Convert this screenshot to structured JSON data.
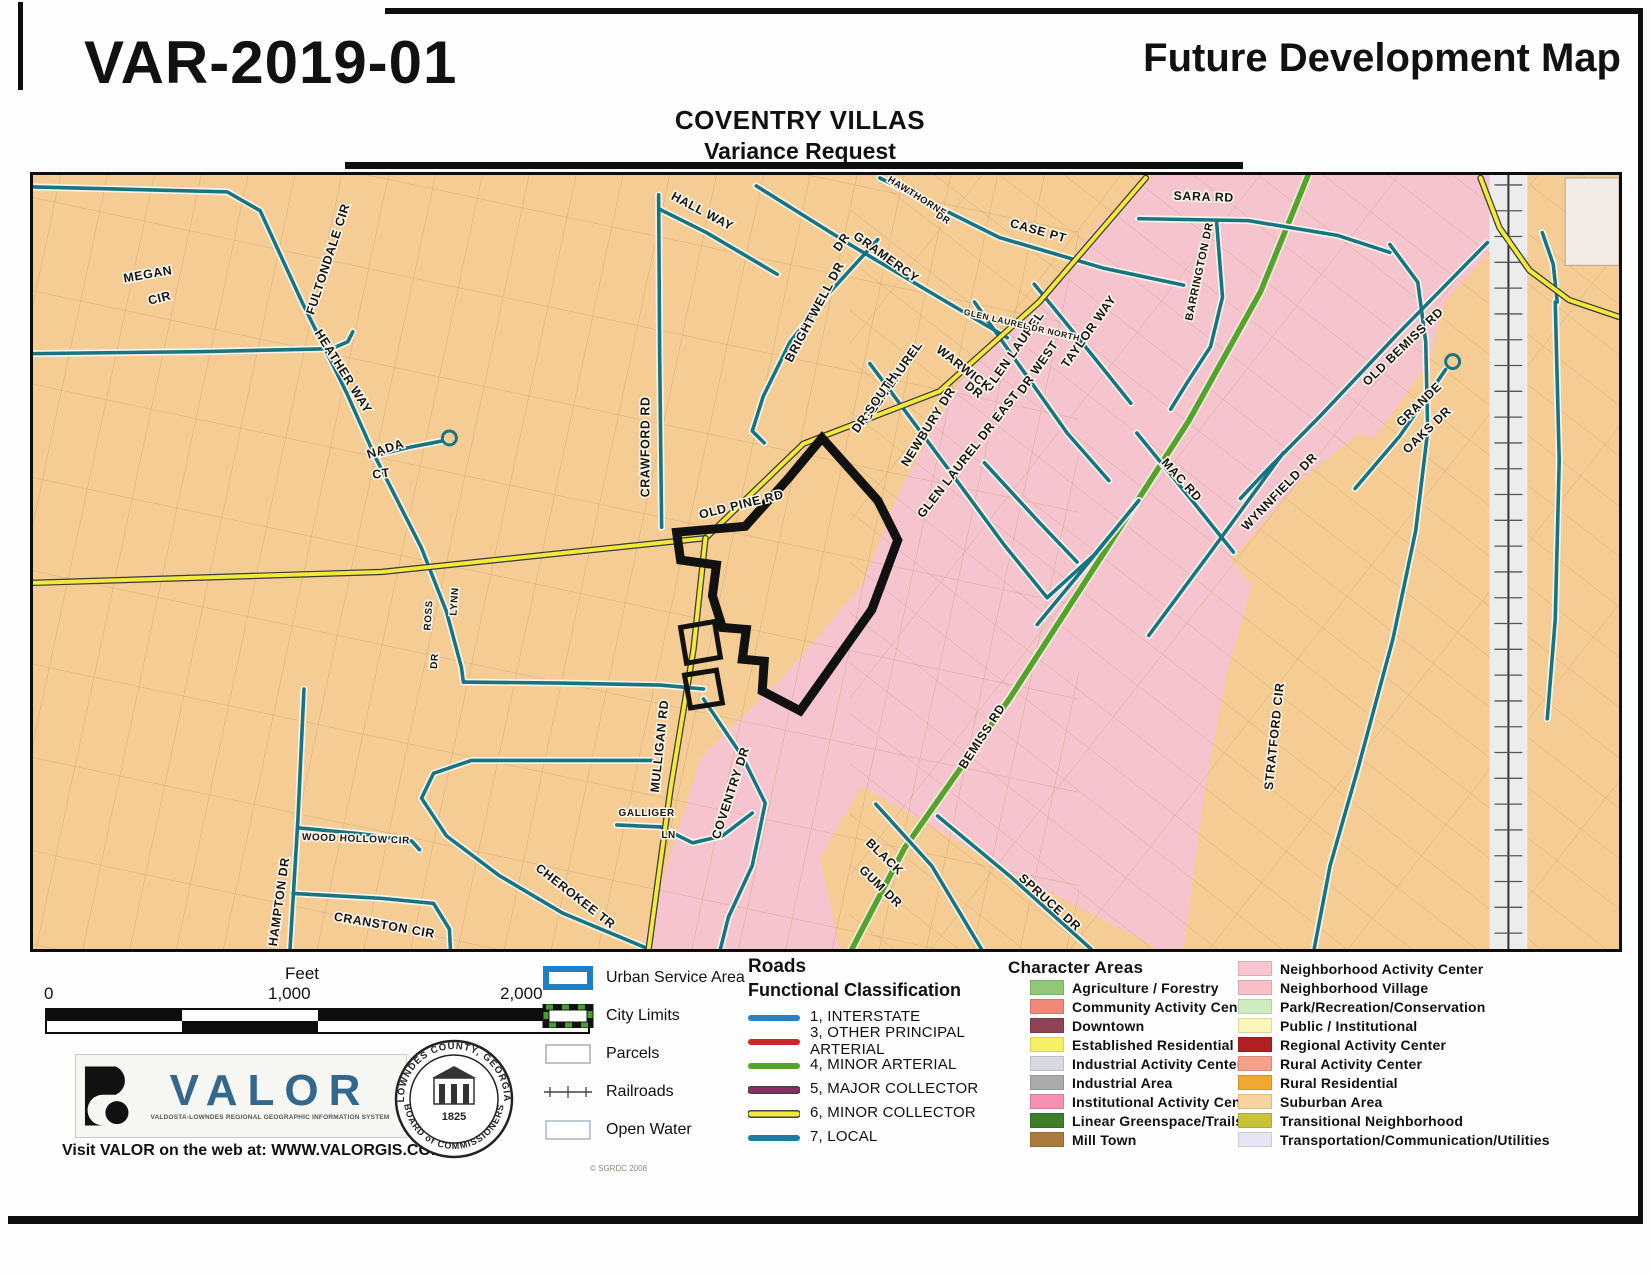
{
  "header": {
    "case_number": "VAR-2019-01",
    "map_title": "Future Development Map",
    "subtitle_line1": "COVENTRY VILLAS",
    "subtitle_line2": "Variance Request"
  },
  "colors": {
    "suburban_orange": "#f5cc93",
    "pink_area": "#f6c4ce",
    "local_road": "#177482",
    "minor_collector": "#f3e93a",
    "minor_arterial": "#55a22c",
    "parcel_line": "#bf9e70",
    "variance_outline": "#111111"
  },
  "map": {
    "street_labels": [
      {
        "t": "MEGAN",
        "x": 146,
        "y": 276,
        "r": -10
      },
      {
        "t": "CIR",
        "x": 158,
        "y": 300,
        "r": -14
      },
      {
        "t": "FULTONDALE CIR",
        "x": 330,
        "y": 258,
        "r": -72
      },
      {
        "t": "HEATHER WAY",
        "x": 338,
        "y": 372,
        "r": 58
      },
      {
        "t": "NADA",
        "x": 385,
        "y": 452,
        "r": -18
      },
      {
        "t": "CT",
        "x": 380,
        "y": 477,
        "r": -8
      },
      {
        "t": "ROSS",
        "x": 430,
        "y": 616,
        "r": -86,
        "s": 10
      },
      {
        "t": "DR",
        "x": 436,
        "y": 662,
        "r": -86,
        "s": 10
      },
      {
        "t": "LYNN",
        "x": 456,
        "y": 602,
        "r": -86,
        "s": 10
      },
      {
        "t": "HALL WAY",
        "x": 700,
        "y": 212,
        "r": 28
      },
      {
        "t": "CRAWFORD RD",
        "x": 649,
        "y": 446,
        "r": -90
      },
      {
        "t": "OLD PINE RD",
        "x": 742,
        "y": 508,
        "r": -14
      },
      {
        "t": "MULLIGAN RD",
        "x": 663,
        "y": 748,
        "r": -84
      },
      {
        "t": "GRAMERCY",
        "x": 884,
        "y": 258,
        "r": 36
      },
      {
        "t": "DR",
        "x": 845,
        "y": 242,
        "r": -55
      },
      {
        "t": "BRIGHTWELL DR",
        "x": 818,
        "y": 312,
        "r": -62
      },
      {
        "t": "HAWTHORNE",
        "x": 916,
        "y": 196,
        "r": 32,
        "s": 9.5
      },
      {
        "t": "DR",
        "x": 942,
        "y": 218,
        "r": 32,
        "s": 9.5
      },
      {
        "t": "CASE PT",
        "x": 1038,
        "y": 232,
        "r": 16
      },
      {
        "t": "GLEN LAUREL",
        "x": 896,
        "y": 382,
        "r": -55
      },
      {
        "t": "DR SOUTH",
        "x": 878,
        "y": 404,
        "r": -55
      },
      {
        "t": "GLEN LAUREL",
        "x": 1018,
        "y": 352,
        "r": -55
      },
      {
        "t": "DR WEST",
        "x": 1042,
        "y": 368,
        "r": -55
      },
      {
        "t": "GLEN LAUREL DR NORTH",
        "x": 1022,
        "y": 326,
        "r": 13,
        "s": 8.5
      },
      {
        "t": "WARWICK",
        "x": 962,
        "y": 370,
        "r": 38
      },
      {
        "t": "DR",
        "x": 972,
        "y": 392,
        "r": 38
      },
      {
        "t": "NEWBURY DR",
        "x": 932,
        "y": 428,
        "r": -58
      },
      {
        "t": "GLEN LAUREL DR EAST",
        "x": 972,
        "y": 456,
        "r": -52
      },
      {
        "t": "TAYLOR WAY",
        "x": 1093,
        "y": 332,
        "r": -55
      },
      {
        "t": "SARA RD",
        "x": 1205,
        "y": 198,
        "r": 2
      },
      {
        "t": "BARRINGTON DR",
        "x": 1204,
        "y": 270,
        "r": -78,
        "s": 11
      },
      {
        "t": "OLD BEMISS RD",
        "x": 1408,
        "y": 348,
        "r": -44
      },
      {
        "t": "GRANDE",
        "x": 1424,
        "y": 406,
        "r": -44
      },
      {
        "t": "OAKS DR",
        "x": 1432,
        "y": 432,
        "r": -44
      },
      {
        "t": "WYNNFIELD DR",
        "x": 1284,
        "y": 494,
        "r": -46
      },
      {
        "t": "MAC RD",
        "x": 1180,
        "y": 482,
        "r": 48
      },
      {
        "t": "STRATFORD CIR",
        "x": 1280,
        "y": 738,
        "r": -84
      },
      {
        "t": "BEMISS RD",
        "x": 986,
        "y": 740,
        "r": -57
      },
      {
        "t": "BLACK",
        "x": 882,
        "y": 862,
        "r": 44
      },
      {
        "t": "GUM DR",
        "x": 878,
        "y": 892,
        "r": 44
      },
      {
        "t": "SPRUCE DR",
        "x": 1048,
        "y": 908,
        "r": 42
      },
      {
        "t": "CHEROKEE TR",
        "x": 572,
        "y": 902,
        "r": 38
      },
      {
        "t": "CRANSTON CIR",
        "x": 382,
        "y": 932,
        "r": 10
      },
      {
        "t": "WOOD HOLLOW CIR",
        "x": 354,
        "y": 844,
        "r": 2,
        "s": 10
      },
      {
        "t": "HAMPTON DR",
        "x": 281,
        "y": 905,
        "r": -82
      },
      {
        "t": "GALLIGER",
        "x": 646,
        "y": 818,
        "r": 0,
        "s": 10
      },
      {
        "t": "LN",
        "x": 668,
        "y": 840,
        "r": 0,
        "s": 10
      },
      {
        "t": "COVENTRY DR",
        "x": 734,
        "y": 796,
        "r": -72
      }
    ]
  },
  "legend": {
    "scale": {
      "unit": "Feet",
      "ticks": [
        "0",
        "1,000",
        "2,000"
      ]
    },
    "symbols": [
      {
        "label": "Urban Service Area",
        "type": "usa"
      },
      {
        "label": "City Limits",
        "type": "city"
      },
      {
        "label": "Parcels",
        "type": "parcel"
      },
      {
        "label": "Railroads",
        "type": "rail"
      },
      {
        "label": "Open Water",
        "type": "water"
      }
    ],
    "roads": {
      "title": "Roads",
      "subtitle": "Functional Classification",
      "items": [
        {
          "label": "1, INTERSTATE",
          "color": "#2b80c2",
          "casing": ""
        },
        {
          "label": "3, OTHER PRINCIPAL ARTERIAL",
          "color": "#cb2629",
          "casing": ""
        },
        {
          "label": "4, MINOR ARTERIAL",
          "color": "#55a22c",
          "casing": ""
        },
        {
          "label": "5, MAJOR COLLECTOR",
          "color": "#8e2c68",
          "casing": "#444444"
        },
        {
          "label": "6, MINOR COLLECTOR",
          "color": "#f3e93a",
          "casing": "#444444"
        },
        {
          "label": "7, LOCAL",
          "color": "#1b7ba0",
          "casing": ""
        }
      ]
    },
    "character_areas": {
      "title": "Character Areas",
      "col1": [
        {
          "label": "Agriculture / Forestry",
          "color": "#90c878"
        },
        {
          "label": "Community Activity Center",
          "color": "#f08878"
        },
        {
          "label": "Downtown",
          "color": "#8e4456"
        },
        {
          "label": "Established Residential",
          "color": "#f6f066"
        },
        {
          "label": "Industrial Activity Center",
          "color": "#d9d9e2"
        },
        {
          "label": "Industrial Area",
          "color": "#ababab"
        },
        {
          "label": "Institutional Activity Center",
          "color": "#f490b0"
        },
        {
          "label": "Linear Greenspace/Trails",
          "color": "#3e7d2c"
        },
        {
          "label": "Mill Town",
          "color": "#a97c3b"
        }
      ],
      "col2": [
        {
          "label": "Neighborhood Activity Center",
          "color": "#f7c6d0"
        },
        {
          "label": "Neighborhood Village",
          "color": "#f9bfc8"
        },
        {
          "label": "Park/Recreation/Conservation",
          "color": "#cdedc1"
        },
        {
          "label": "Public / Institutional",
          "color": "#faf6b8"
        },
        {
          "label": "Regional Activity Center",
          "color": "#b01f24"
        },
        {
          "label": "Rural Activity Center",
          "color": "#f5a088"
        },
        {
          "label": "Rural Residential",
          "color": "#f0a830"
        },
        {
          "label": "Suburban Area",
          "color": "#f8d49e"
        },
        {
          "label": "Transitional Neighborhood",
          "color": "#c8c23a"
        },
        {
          "label": "Transportation/Communication/Utilities",
          "color": "#e6e6f5"
        }
      ]
    }
  },
  "branding": {
    "valor": {
      "name": "VALOR",
      "tagline": "VALDOSTA-LOWNDES REGIONAL GEOGRAPHIC INFORMATION SYSTEM",
      "web": "Visit VALOR on the web at: WWW.VALORGIS.COM",
      "copyright": "© SGRDC 2008"
    },
    "seal": {
      "top": "LOWNDES COUNTY, GEORGIA",
      "bottom": "BOARD of COMMISSIONERS",
      "year": "1825"
    }
  }
}
